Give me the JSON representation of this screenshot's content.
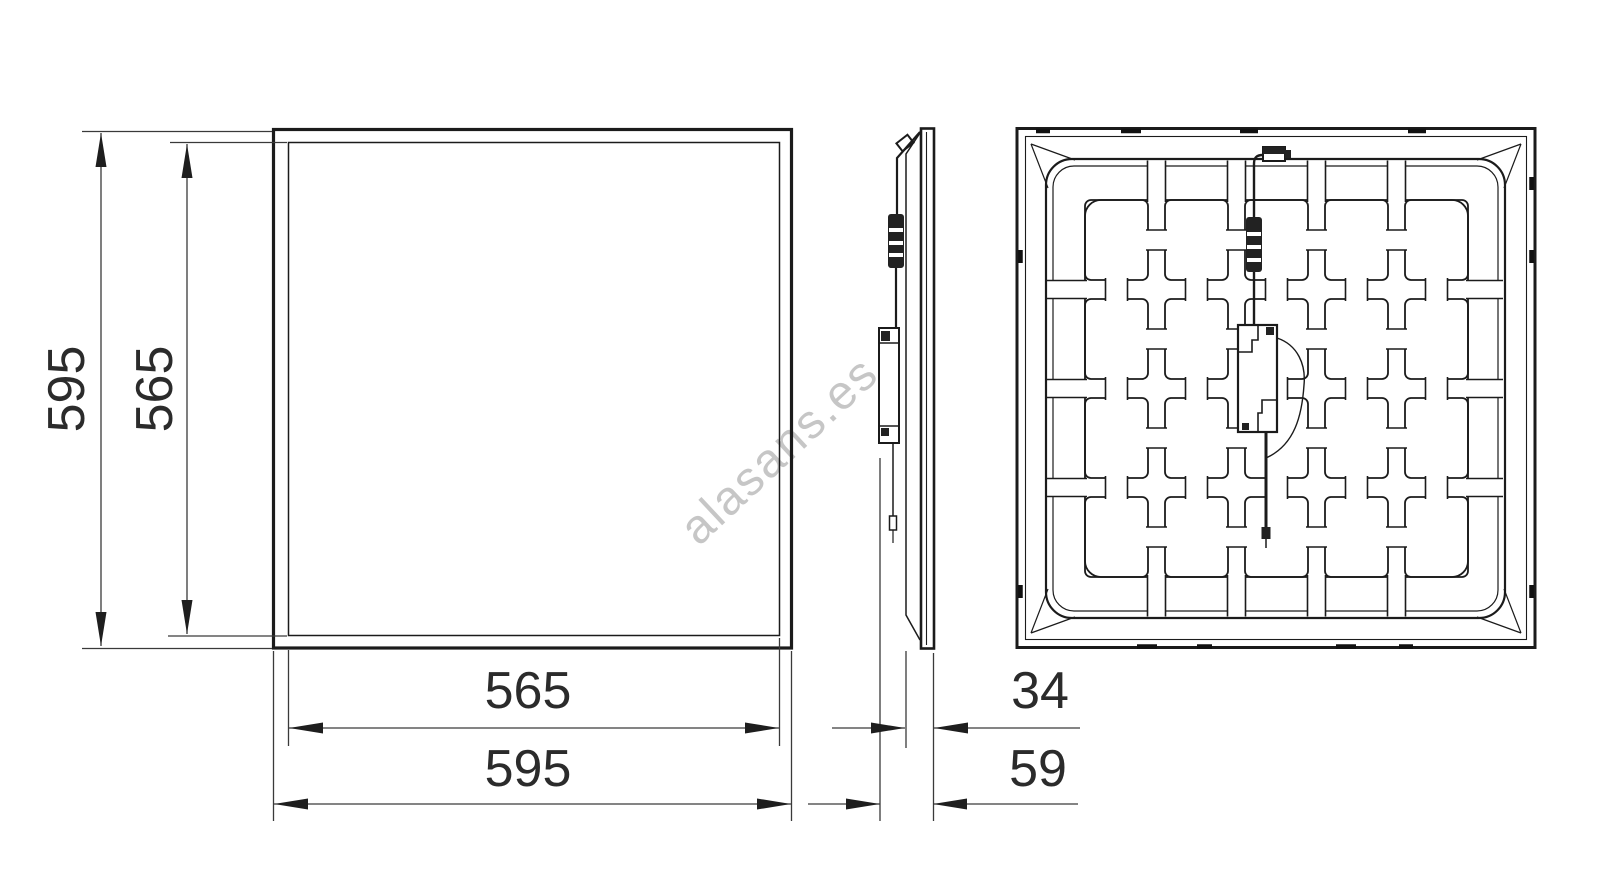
{
  "watermark": {
    "text": "alasans.es"
  },
  "drawing": {
    "colors": {
      "line": "#1b1b1b",
      "dimension": "#3a3a3a",
      "watermark": "#c4c4c4"
    },
    "front_view": {
      "dim_height_outer": "595",
      "dim_height_inner": "565",
      "dim_width_inner": "565",
      "dim_width_outer": "595"
    },
    "side_view": {
      "dim_depth_panel": "34",
      "dim_depth_total": "59"
    }
  }
}
